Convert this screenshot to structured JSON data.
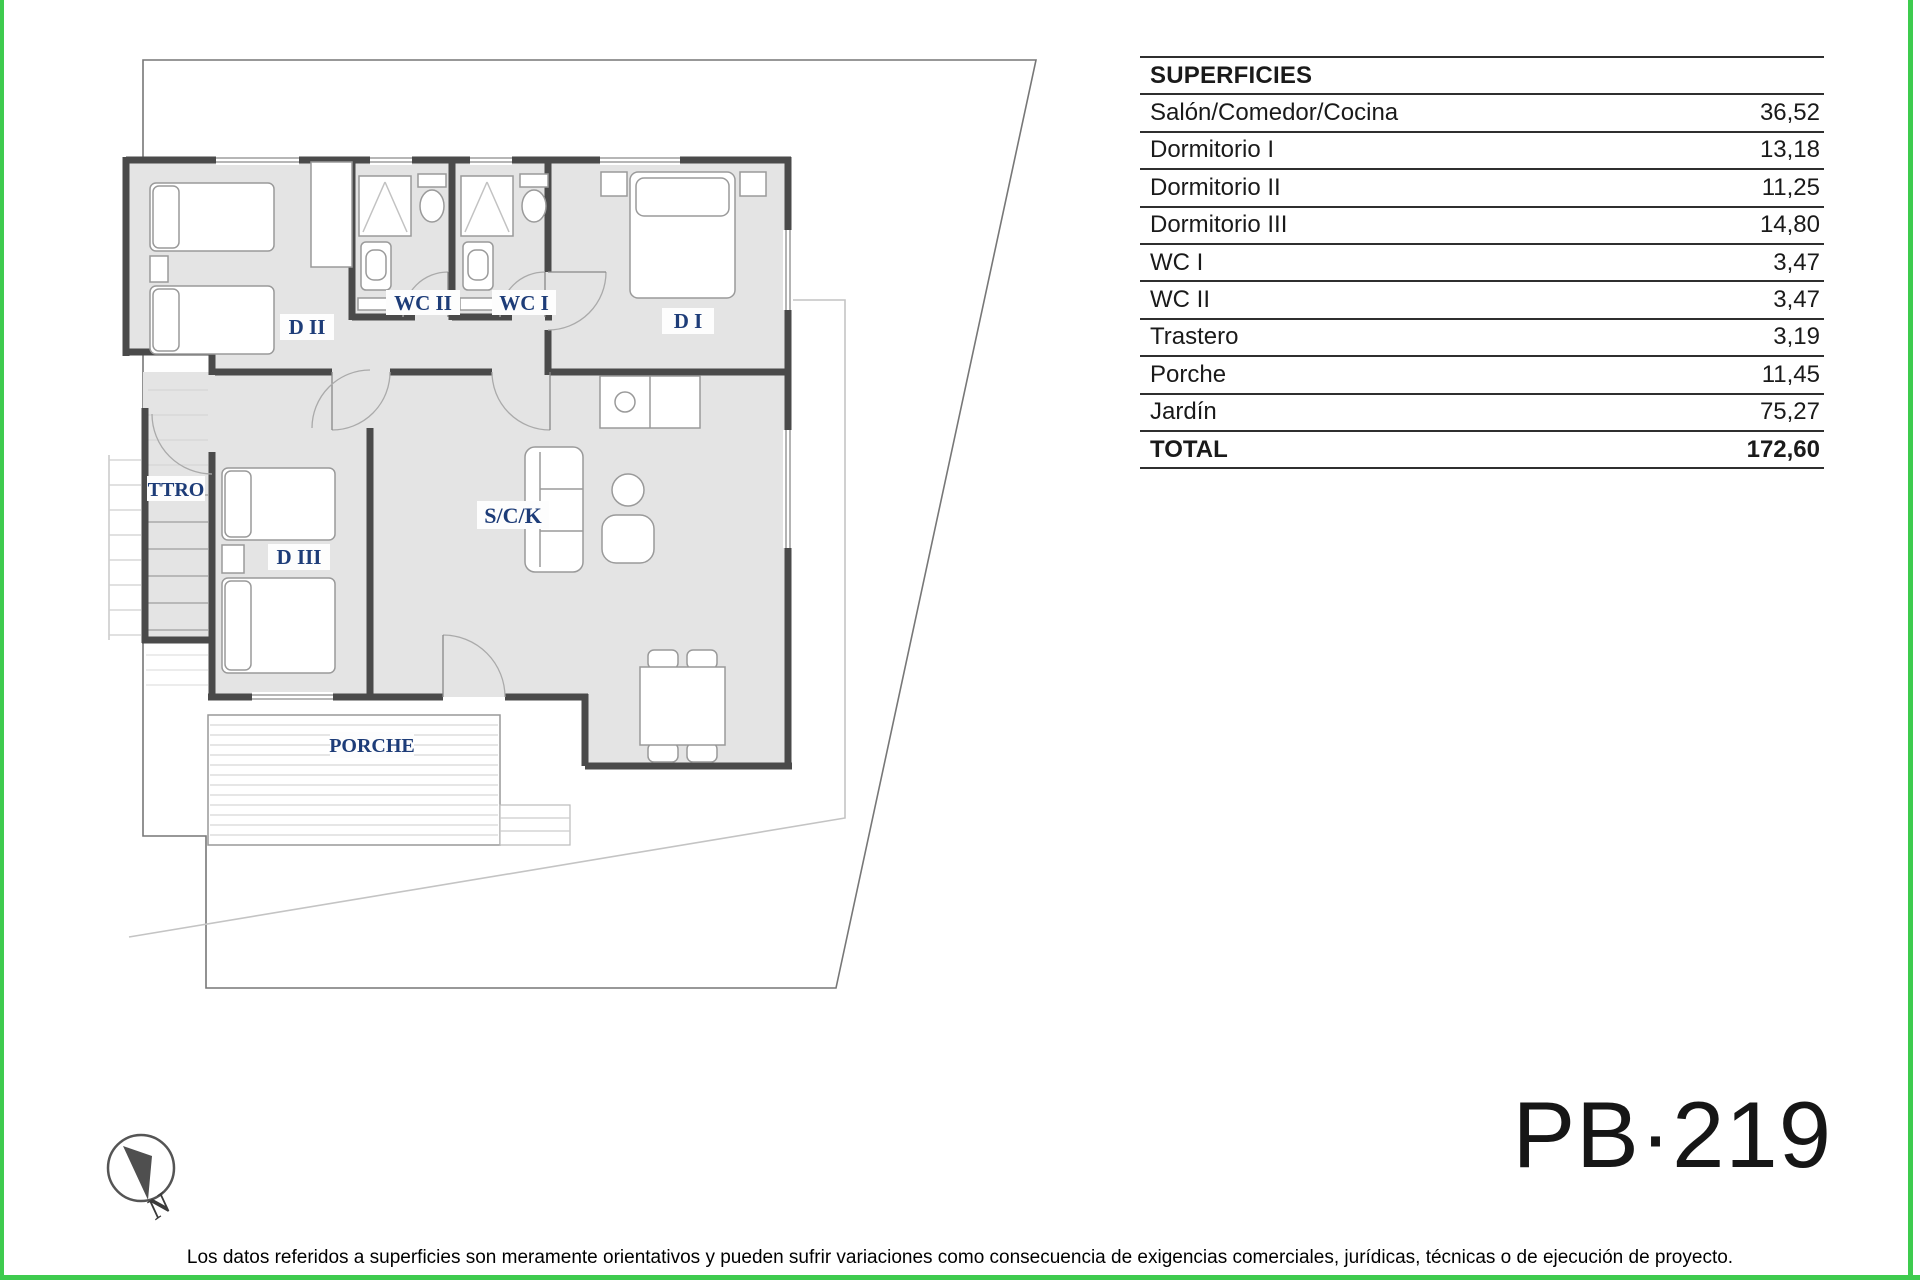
{
  "colors": {
    "accent_green": "#3ecb4e",
    "label_blue": "#1d3c78",
    "wall_gray": "#4a4a4a",
    "floor_gray": "#e4e4e4"
  },
  "surfaces_table": {
    "header": "SUPERFICIES",
    "rows": [
      {
        "label": "Salón/Comedor/Cocina",
        "value": "36,52"
      },
      {
        "label": "Dormitorio I",
        "value": "13,18"
      },
      {
        "label": "Dormitorio II",
        "value": "11,25"
      },
      {
        "label": "Dormitorio III",
        "value": "14,80"
      },
      {
        "label": "WC I",
        "value": "3,47"
      },
      {
        "label": "WC II",
        "value": "3,47"
      },
      {
        "label": "Trastero",
        "value": "3,19"
      },
      {
        "label": "Porche",
        "value": "11,45"
      },
      {
        "label": "Jardín",
        "value": "75,27"
      }
    ],
    "total": {
      "label": "TOTAL",
      "value": "172,60"
    }
  },
  "plan": {
    "labels": {
      "d2": "D II",
      "wc2": "WC II",
      "wc1": "WC I",
      "d1": "D I",
      "ttro": "TTRO",
      "d3": "D III",
      "sck": "S/C/K",
      "porche": "PORCHE"
    },
    "north": "N"
  },
  "plan_code": "PB·219",
  "disclaimer": "Los datos referidos a superficies son meramente orientativos y pueden sufrir variaciones como consecuencia de exigencias comerciales, jurídicas, técnicas o de ejecución de proyecto."
}
